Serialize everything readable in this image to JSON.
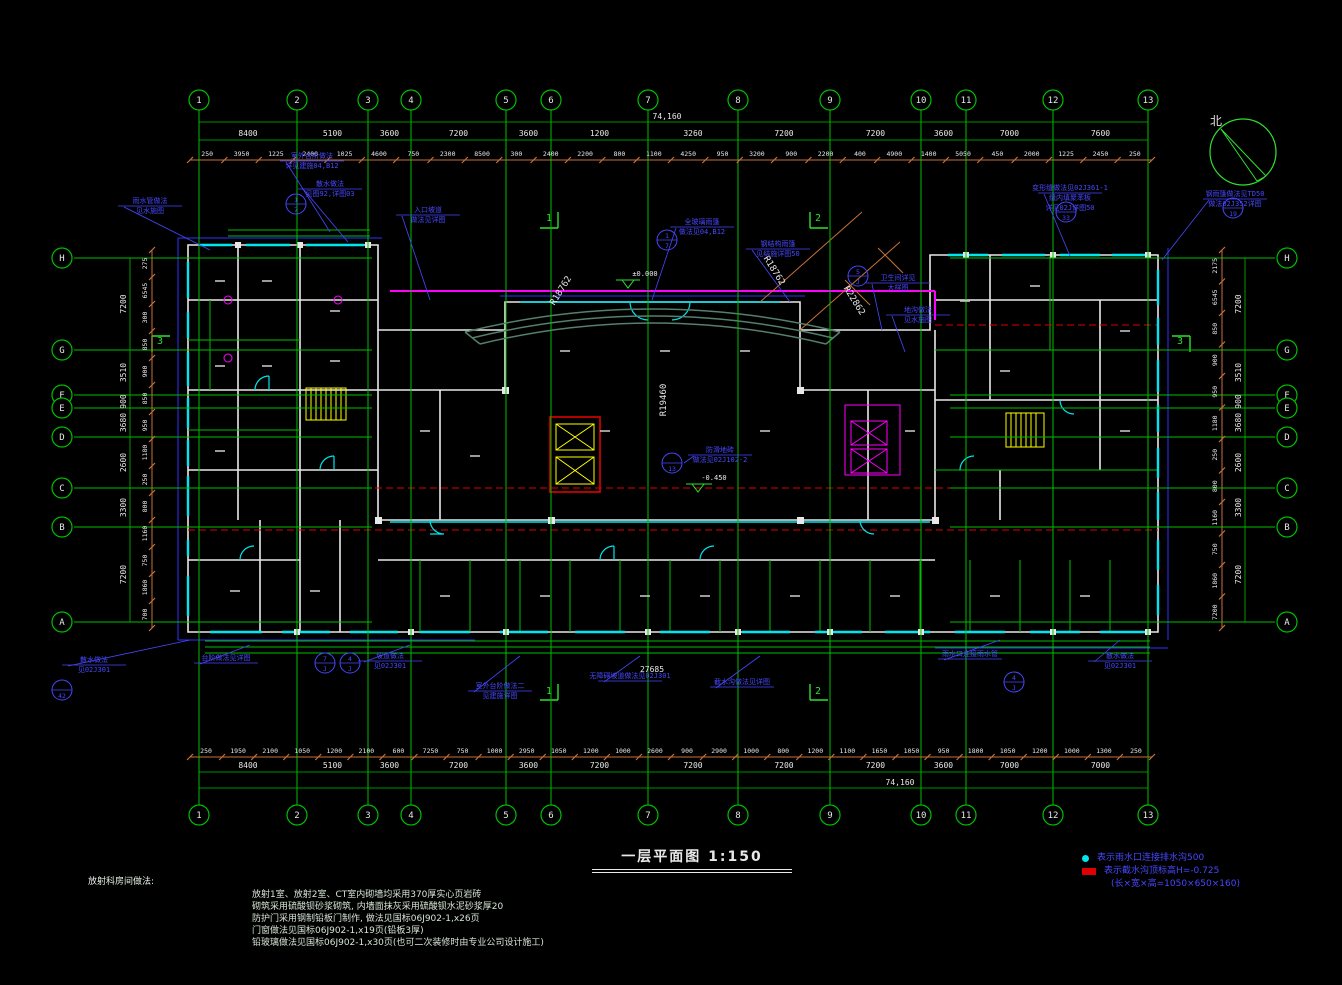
{
  "title": {
    "text": "一层平面图 1:150"
  },
  "north": {
    "label": "北"
  },
  "grid": {
    "cols": [
      "1",
      "2",
      "3",
      "4",
      "5",
      "6",
      "7",
      "8",
      "9",
      "10",
      "11",
      "12",
      "13"
    ],
    "cols_x": [
      199,
      297,
      368,
      411,
      506,
      551,
      648,
      738,
      830,
      921,
      966,
      1053,
      1148
    ],
    "rows": [
      "H",
      "G",
      "F",
      "E",
      "D",
      "C",
      "B",
      "A"
    ],
    "rows_y": [
      258,
      350,
      395,
      408,
      437,
      488,
      527,
      622
    ],
    "top_dims": [
      "8400",
      "5100",
      "3600",
      "7200",
      "3600",
      "1200",
      "3260",
      "7200",
      "7200",
      "3600",
      "7000",
      "7600"
    ],
    "bottom_dims": [
      "8400",
      "5100",
      "3600",
      "7200",
      "3600",
      "7200",
      "7200",
      "7200",
      "7200",
      "3600",
      "7000",
      "7000"
    ],
    "total_width_top": "74,160",
    "total_width_bottom": "74,160",
    "row_dims": [
      "7200",
      "3510",
      "900",
      "3680",
      "2600",
      "3300",
      "7200"
    ],
    "top_sub_dims": [
      "250",
      "3950",
      "1225",
      "2400",
      "1025",
      "4600",
      "750",
      "2300",
      "8500",
      "300",
      "2400",
      "2200",
      "800",
      "1100",
      "4250",
      "950",
      "3200",
      "900",
      "2200",
      "400",
      "4900",
      "1400",
      "5050",
      "450",
      "2000",
      "1225",
      "2450",
      "250"
    ],
    "bottom_sub_dims": [
      "250",
      "1950",
      "2100",
      "1050",
      "1200",
      "2100",
      "600",
      "7250",
      "750",
      "1000",
      "2950",
      "1050",
      "1200",
      "1000",
      "2600",
      "900",
      "2900",
      "1000",
      "800",
      "1200",
      "1100",
      "1650",
      "1050",
      "950",
      "1800",
      "1050",
      "1200",
      "1000",
      "1300",
      "250"
    ],
    "left_sub_dims": [
      "275",
      "6545",
      "300",
      "850",
      "900",
      "850",
      "950",
      "1180",
      "250",
      "800",
      "1160",
      "750",
      "1860",
      "700"
    ],
    "right_sub_dims": [
      "2175",
      "6545",
      "850",
      "900",
      "950",
      "1180",
      "250",
      "800",
      "1160",
      "750",
      "1860",
      "7200"
    ]
  },
  "plan_texts": [
    {
      "t": "R18762",
      "x": 563,
      "y": 292,
      "r": -58,
      "c": "#e8e8e8",
      "s": 9
    },
    {
      "t": "R19460",
      "x": 666,
      "y": 400,
      "r": -90,
      "c": "#e8e8e8",
      "s": 9
    },
    {
      "t": "R18762",
      "x": 772,
      "y": 272,
      "r": 58,
      "c": "#e8e8e8",
      "s": 9
    },
    {
      "t": "R22862",
      "x": 852,
      "y": 302,
      "r": 58,
      "c": "#e8e8e8",
      "s": 9
    },
    {
      "t": "27685",
      "x": 652,
      "y": 672,
      "r": 0,
      "c": "#e8e8e8",
      "s": 8
    },
    {
      "t": "±0.000",
      "x": 645,
      "y": 276,
      "r": 0,
      "c": "#e8e8e8",
      "s": 7
    },
    {
      "t": "-0.450",
      "x": 714,
      "y": 480,
      "r": 0,
      "c": "#e8e8e8",
      "s": 7
    },
    {
      "t": "1",
      "x": 549,
      "y": 221,
      "r": 0,
      "c": "#2fdf2f",
      "s": 10
    },
    {
      "t": "1",
      "x": 549,
      "y": 694,
      "r": 0,
      "c": "#2fdf2f",
      "s": 10
    },
    {
      "t": "2",
      "x": 818,
      "y": 221,
      "r": 0,
      "c": "#2fdf2f",
      "s": 10
    },
    {
      "t": "2",
      "x": 818,
      "y": 694,
      "r": 0,
      "c": "#2fdf2f",
      "s": 10
    },
    {
      "t": "3",
      "x": 160,
      "y": 344,
      "r": 0,
      "c": "#2fdf2f",
      "s": 10
    },
    {
      "t": "3",
      "x": 1180,
      "y": 344,
      "r": 0,
      "c": "#2fdf2f",
      "s": 10
    }
  ],
  "callouts": [
    {
      "x": 120,
      "y": 203,
      "lines": [
        "雨水管做法",
        "见水施图"
      ],
      "lx": 210,
      "ly": 250
    },
    {
      "x": 282,
      "y": 158,
      "lines": [
        "室外台阶做法",
        "详见建施04,B12"
      ],
      "lx": 330,
      "ly": 232
    },
    {
      "x": 300,
      "y": 186,
      "lines": [
        "散水做法",
        "见图92,详图03"
      ],
      "lx": 348,
      "ly": 242
    },
    {
      "x": 398,
      "y": 212,
      "lines": [
        "入口坡道",
        "做法见详图"
      ],
      "lx": 430,
      "ly": 300
    },
    {
      "x": 672,
      "y": 224,
      "lines": [
        "全玻璃雨篷",
        "做法见04,B12"
      ],
      "lx": 652,
      "ly": 300
    },
    {
      "x": 748,
      "y": 246,
      "lines": [
        "钢结构雨篷",
        "见结施详图50"
      ],
      "lx": 790,
      "ly": 302
    },
    {
      "x": 868,
      "y": 280,
      "lines": [
        "卫生间详见",
        "大样图"
      ],
      "lx": 882,
      "ly": 330
    },
    {
      "x": 888,
      "y": 312,
      "lines": [
        "地沟做法",
        "见水施图"
      ],
      "lx": 905,
      "ly": 352
    },
    {
      "x": 1040,
      "y": 190,
      "lines": [
        "变形缝做法见02J361-1",
        "缝内填聚苯板",
        "详见02J详图50"
      ],
      "lx": 1070,
      "ly": 256
    },
    {
      "x": 1205,
      "y": 196,
      "lines": [
        "钢雨篷做法见TD50",
        "做法02J352详图"
      ],
      "lx": 1162,
      "ly": 260
    },
    {
      "x": 64,
      "y": 662,
      "lines": [
        "散水做法",
        "见02J301"
      ],
      "lx": 190,
      "ly": 640
    },
    {
      "x": 196,
      "y": 660,
      "lines": [
        "台阶做法见详图"
      ],
      "lx": 250,
      "ly": 645
    },
    {
      "x": 360,
      "y": 658,
      "lines": [
        "坡道做法",
        "见02J301"
      ],
      "lx": 410,
      "ly": 645
    },
    {
      "x": 470,
      "y": 688,
      "lines": [
        "室外台阶做法二",
        "见建施详图"
      ],
      "lx": 520,
      "ly": 656
    },
    {
      "x": 600,
      "y": 678,
      "lines": [
        "无障碍坡道做法见02J301"
      ],
      "lx": 640,
      "ly": 656
    },
    {
      "x": 712,
      "y": 684,
      "lines": [
        "截水沟做法见详图"
      ],
      "lx": 760,
      "ly": 656
    },
    {
      "x": 940,
      "y": 656,
      "lines": [
        "雨水口连接雨水管"
      ],
      "lx": 1000,
      "ly": 640
    },
    {
      "x": 1090,
      "y": 658,
      "lines": [
        "散水做法",
        "见02J301"
      ],
      "lx": 1120,
      "ly": 640
    },
    {
      "x": 690,
      "y": 452,
      "lines": [
        "防滑地砖",
        "做法见02J102-2"
      ],
      "lx": 684,
      "ly": 463
    }
  ],
  "detail_circles": [
    {
      "x": 296,
      "y": 204,
      "a": "1",
      "b": "7"
    },
    {
      "x": 667,
      "y": 240,
      "a": "1",
      "b": "7"
    },
    {
      "x": 858,
      "y": 276,
      "a": "5",
      "b": "J"
    },
    {
      "x": 1066,
      "y": 212,
      "a": "",
      "b": "33"
    },
    {
      "x": 1233,
      "y": 208,
      "a": "",
      "b": "19"
    },
    {
      "x": 62,
      "y": 690,
      "a": "",
      "b": "42"
    },
    {
      "x": 325,
      "y": 663,
      "a": "7",
      "b": "J"
    },
    {
      "x": 350,
      "y": 663,
      "a": "4",
      "b": "J"
    },
    {
      "x": 672,
      "y": 463,
      "a": "",
      "b": "13"
    },
    {
      "x": 1014,
      "y": 682,
      "a": "4",
      "b": "J"
    }
  ],
  "legend": {
    "items": [
      {
        "symbol": "circle",
        "text": "表示雨水口连接排水沟500",
        "text2": ""
      },
      {
        "symbol": "rect",
        "text": "表示截水沟顶标高H=-0.725",
        "text2": "(长×宽×高=1050×650×160)"
      }
    ]
  },
  "notes": {
    "heading": "放射科房间做法:",
    "lines": [
      "放射1室、放射2室、CT室内砌墙均采用370厚实心页岩砖",
      "砌筑采用硫酸钡砂浆砌筑, 内墙面抹灰采用硫酸钡水泥砂浆厚20",
      "防护门采用钢制铅板门制作, 做法见国标06J902-1,x26页",
      "门窗做法见国标06J902-1,x19页(铅板3厚)",
      "铅玻璃做法见国标06J902-1,x30页(也可二次装修时由专业公司设计施工)"
    ]
  },
  "colors": {
    "grid": "#00bf00",
    "dim_tick": "#c87137",
    "wall": "#e8e8e8",
    "window": "#00e5ee",
    "annotation": "#4747ff",
    "axis_center": "#e00000",
    "fixture": "#ff00ff",
    "stair": "#ffff00",
    "canopy": "#55806b"
  }
}
